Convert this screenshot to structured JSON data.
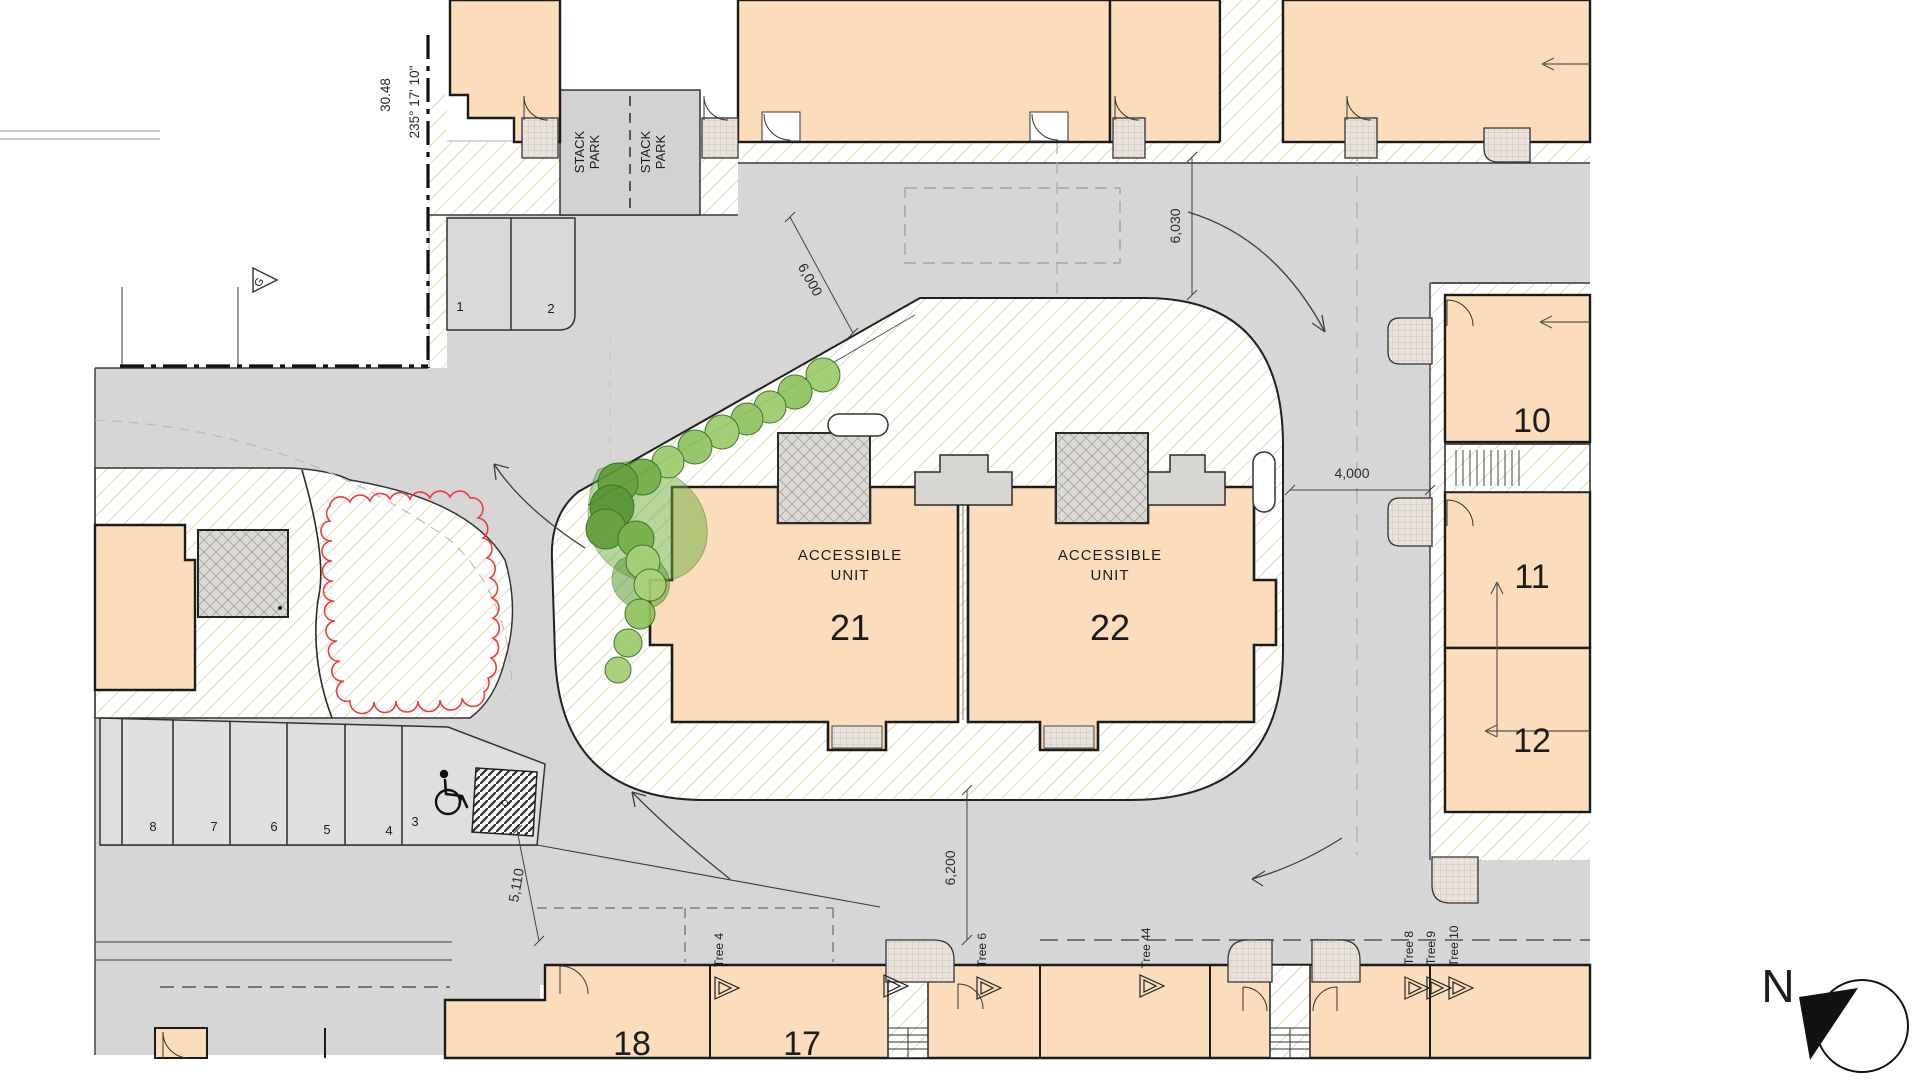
{
  "labels": {
    "stack_line1": "STACK",
    "stack_line2": "PARK",
    "accessible_line1": "ACCESSIBLE",
    "accessible_line2": "UNIT",
    "north": "N",
    "survey_marker": "G"
  },
  "units": {
    "u10": "10",
    "u11": "11",
    "u12": "12",
    "u17": "17",
    "u18": "18",
    "u21": "21",
    "u22": "22"
  },
  "parking_spaces": [
    "1",
    "2",
    "3",
    "4",
    "5",
    "6",
    "7",
    "8"
  ],
  "dimensions": {
    "boundary_length": "30.48",
    "boundary_bearing": "235° 17' 10\"",
    "top_road_width": "6,000",
    "right_top_road_width": "6,030",
    "east_road_width": "4,000",
    "south_road_width": "6,200",
    "southwest_road_width": "5,110"
  },
  "trees": {
    "tree_4": "Tree 4",
    "tree_6": "Tree 6",
    "tree_8": "Tree 8",
    "tree_9": "Tree 9",
    "tree_10": "Tree 10",
    "tree_44": "Tree 44"
  },
  "colors": {
    "building_fill": "#FBDDBB",
    "road_fill": "#D6D6D6",
    "parking_fill": "#DFDFDF",
    "tree_green_light": "#9CCB6C",
    "tree_green_dark": "#5C9B33",
    "tree_outline_red": "#F23B3B",
    "plot_hatch": "#DAD6A4"
  }
}
